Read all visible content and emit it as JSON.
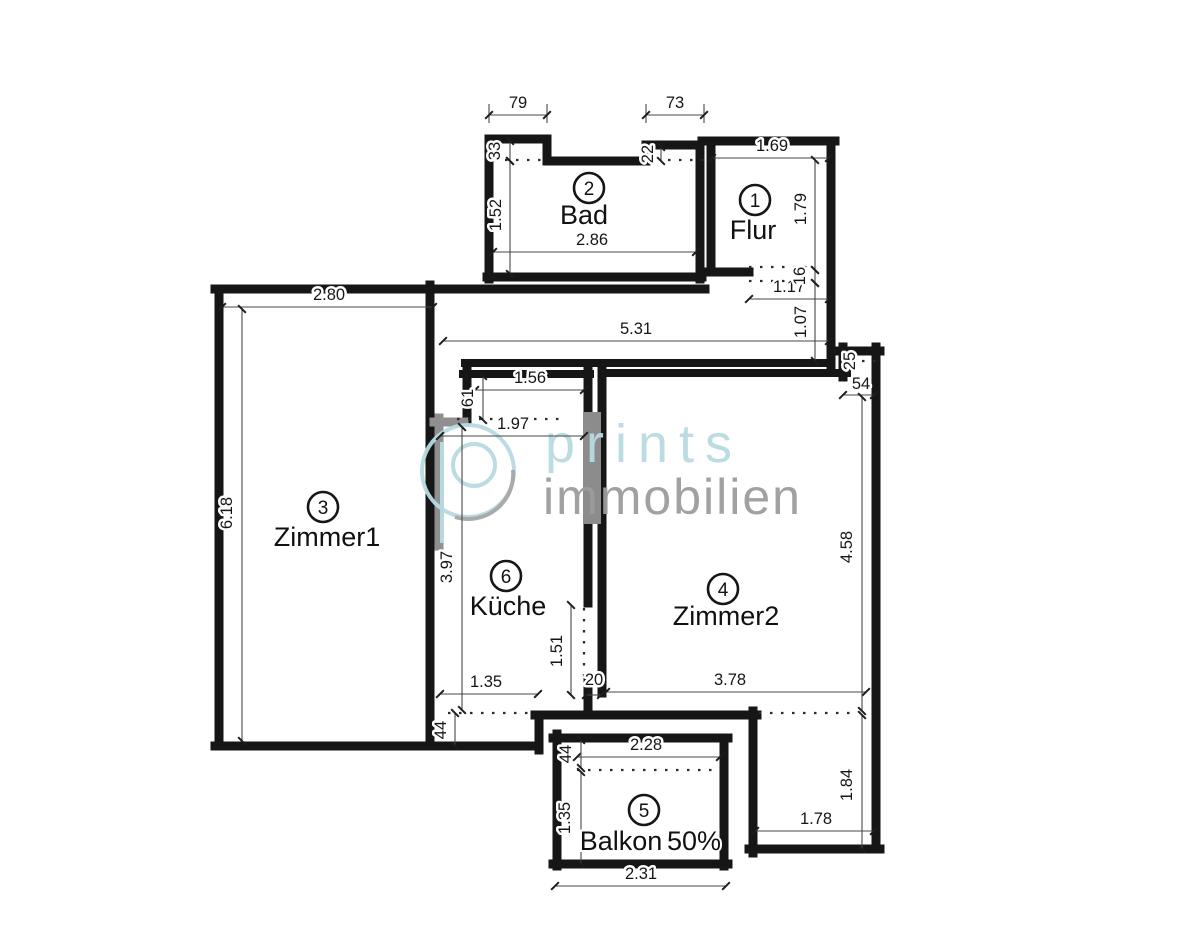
{
  "watermark": {
    "brand_top": "prints",
    "brand_bottom": "immobilien",
    "accent_color": "#b9dbe2",
    "gray_color": "#9c9c9c"
  },
  "rooms": [
    {
      "number": "1",
      "name": "Flur"
    },
    {
      "number": "2",
      "name": "Bad"
    },
    {
      "number": "3",
      "name": "Zimmer1"
    },
    {
      "number": "4",
      "name": "Zimmer2"
    },
    {
      "number": "5",
      "name": "Balkon",
      "suffix": "50%"
    },
    {
      "number": "6",
      "name": "Küche"
    }
  ],
  "dims": {
    "bad_top_left": "79",
    "bad_top_right": "73",
    "bad_step_left": "33",
    "bad_step_right": "22",
    "bad_height": "1.52",
    "bad_width": "2.86",
    "flur_width": "1.69",
    "flur_height": "1.79",
    "flur_door_offset": "16",
    "flur_door_width": "1.17",
    "hall_height": "1.07",
    "zimmer1_width": "2.80",
    "hall_width": "5.31",
    "zimmer1_height": "6.18",
    "kueche_top_width": "1.56",
    "kueche_step": "61",
    "kueche_opening": "1.97",
    "kueche_height": "3.97",
    "kueche_bottom_width": "1.35",
    "kueche_door_height": "1.51",
    "kueche_door_gap": "20",
    "kueche_bottom_step": "44",
    "zimmer2_notch_depth": "25",
    "zimmer2_notch_width": "54",
    "zimmer2_height": "4.58",
    "zimmer2_width": "3.78",
    "zimmer2_lower_height": "1.84",
    "zimmer2_lower_width": "1.78",
    "balkon_top_width": "2.28",
    "balkon_rail": "44",
    "balkon_height": "1.35",
    "balkon_bottom_width": "2.31"
  }
}
